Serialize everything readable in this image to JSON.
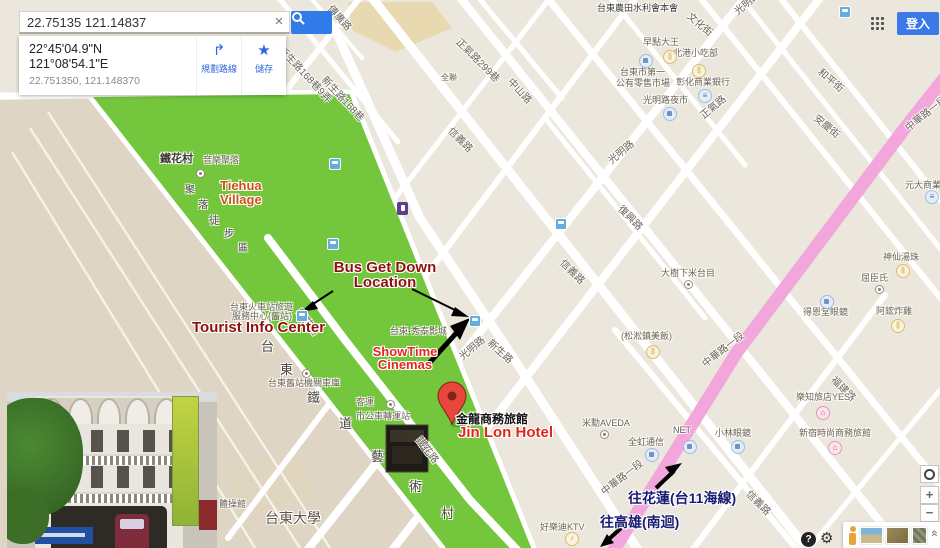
{
  "topbar": {
    "signin": "登入"
  },
  "search": {
    "query": "22.75135 121.14837",
    "clear": "×"
  },
  "place_card": {
    "lat_dms": "22°45'04.9\"N",
    "lng_dms": "121°08'54.1\"E",
    "decimal": "22.751350, 121.148370",
    "directions_label": "規劃路線",
    "directions_glyph": "↱",
    "save_label": "儲存",
    "save_glyph": "★"
  },
  "annotations": {
    "bus_line1": "Bus Get Down",
    "bus_line2": "Location",
    "tourist": "Tourist Info Center",
    "showtime_line1": "ShowTime",
    "showtime_line2": "Cinemas",
    "jinlon_cn": "金龍商務旅館",
    "jinlon_en": "Jin Lon Hotel",
    "tiehua_line1": "Tiehua",
    "tiehua_line2": "Village",
    "hualien": "往花蓮(台11海線)",
    "kaohsiung": "往高雄(南迴)"
  },
  "colors": {
    "park_green": "#74C63C",
    "major_road_pink": "#F2A6DC",
    "pin_red": "#E8453C",
    "annotation_dark_red": "#8D120D",
    "annotation_red": "#DE2A1C",
    "annotation_navy": "#181C72",
    "search_blue": "#2E7BE9",
    "signin_blue": "#3B78E8"
  },
  "controls": {
    "zoom_in": "+",
    "zoom_out": "−",
    "help": "?",
    "collapse": "«"
  },
  "map": {
    "street_labels": [
      {
        "t": "傳廣路",
        "x": 336,
        "y": 1,
        "r": 48
      },
      {
        "t": "新生路168巷9弄",
        "x": 287,
        "y": 42,
        "r": 47
      },
      {
        "t": "新生路168巷",
        "x": 330,
        "y": 72,
        "r": 47
      },
      {
        "t": "正氣路299巷",
        "x": 464,
        "y": 34,
        "r": 45
      },
      {
        "t": "中山路",
        "x": 516,
        "y": 74,
        "r": 47
      },
      {
        "t": "文化街",
        "x": 694,
        "y": 8,
        "r": 40
      },
      {
        "t": "和平街",
        "x": 825,
        "y": 64,
        "r": 40
      },
      {
        "t": "安慶街",
        "x": 821,
        "y": 110,
        "r": 40
      },
      {
        "t": "光明路",
        "x": 730,
        "y": 6,
        "r": -40
      },
      {
        "t": "光明路",
        "x": 604,
        "y": 155,
        "r": -40
      },
      {
        "t": "光明路",
        "x": 455,
        "y": 351,
        "r": -40
      },
      {
        "t": "正氣路",
        "x": 696,
        "y": 110,
        "r": -40
      },
      {
        "t": "信義路",
        "x": 456,
        "y": 123,
        "r": 45
      },
      {
        "t": "信義路",
        "x": 568,
        "y": 255,
        "r": 45
      },
      {
        "t": "信義路",
        "x": 754,
        "y": 486,
        "r": 45
      },
      {
        "t": "新生路",
        "x": 495,
        "y": 335,
        "r": 42
      },
      {
        "t": "鐵花路",
        "x": 305,
        "y": 305,
        "r": 52
      },
      {
        "t": "鐵花路",
        "x": 425,
        "y": 433,
        "r": 52
      },
      {
        "t": "復興路",
        "x": 626,
        "y": 201,
        "r": 45
      },
      {
        "t": "福建路",
        "x": 839,
        "y": 372,
        "r": 45
      },
      {
        "t": "中華路一段",
        "x": 901,
        "y": 122,
        "r": -38
      },
      {
        "t": "中華路一段",
        "x": 698,
        "y": 358,
        "r": -38
      },
      {
        "t": "中華路一段",
        "x": 597,
        "y": 486,
        "r": -38
      }
    ],
    "poi_labels": [
      {
        "t": "台東農田水利會本會",
        "x": 597,
        "y": 1,
        "s": 9,
        "c": "#3A3A3A"
      },
      {
        "t": "鐵花村",
        "x": 160,
        "y": 150,
        "s": 11,
        "c": "#3F3A31",
        "b": 1
      },
      {
        "t": "音樂聚落",
        "x": 203,
        "y": 153,
        "s": 9
      },
      {
        "t": "台東火車站旅遊",
        "x": 230,
        "y": 300,
        "s": 9
      },
      {
        "t": "服務中心(舊站)",
        "x": 232,
        "y": 309,
        "s": 9
      },
      {
        "t": "台東舊站機關車庫",
        "x": 268,
        "y": 376,
        "s": 9
      },
      {
        "t": "客運",
        "x": 356,
        "y": 395,
        "s": 9
      },
      {
        "t": "市公車轉運站",
        "x": 356,
        "y": 409,
        "s": 9
      },
      {
        "t": "台東·秀泰影城",
        "x": 390,
        "y": 324,
        "s": 9
      },
      {
        "t": "台東大學",
        "x": 265,
        "y": 508,
        "s": 14,
        "c": "#5F5648"
      },
      {
        "t": "體操館",
        "x": 219,
        "y": 497,
        "s": 9
      },
      {
        "t": "好樂迪KTV",
        "x": 540,
        "y": 520,
        "s": 9
      },
      {
        "t": "早點大王",
        "x": 643,
        "y": 35,
        "s": 9
      },
      {
        "t": "北港小吃部",
        "x": 673,
        "y": 46,
        "s": 9
      },
      {
        "t": "台東市第一",
        "x": 620,
        "y": 65,
        "s": 9
      },
      {
        "t": "公有零售市場",
        "x": 616,
        "y": 76,
        "s": 9
      },
      {
        "t": "彰化商業銀行",
        "x": 676,
        "y": 75,
        "s": 9
      },
      {
        "t": "光明路夜市",
        "x": 643,
        "y": 93,
        "s": 9
      },
      {
        "t": "大樹下米台目",
        "x": 661,
        "y": 266,
        "s": 9
      },
      {
        "t": "(松淞鎮美飯)",
        "x": 621,
        "y": 329,
        "s": 9
      },
      {
        "t": "得恩堂眼鏡",
        "x": 803,
        "y": 305,
        "s": 9
      },
      {
        "t": "神仙湯珠",
        "x": 883,
        "y": 250,
        "s": 9
      },
      {
        "t": "屈臣氏",
        "x": 861,
        "y": 271,
        "s": 9
      },
      {
        "t": "阿鋐炸雞",
        "x": 876,
        "y": 304,
        "s": 9
      },
      {
        "t": "元大商業銀行",
        "x": 905,
        "y": 178,
        "s": 9
      },
      {
        "t": "全聯",
        "x": 441,
        "y": 72,
        "s": 8
      },
      {
        "t": "米勳AVEDA",
        "x": 582,
        "y": 416,
        "s": 9
      },
      {
        "t": "全虹通信",
        "x": 628,
        "y": 435,
        "s": 9
      },
      {
        "t": "NET",
        "x": 673,
        "y": 425,
        "s": 9
      },
      {
        "t": "小林眼鏡",
        "x": 715,
        "y": 426,
        "s": 9
      },
      {
        "t": "樂知旅店YES",
        "x": 796,
        "y": 390,
        "s": 9
      },
      {
        "t": "新宿時尚商務旅館",
        "x": 799,
        "y": 426,
        "s": 9
      }
    ],
    "vertical_chars": [
      {
        "t": "台",
        "x": 261,
        "y": 336,
        "s": 13
      },
      {
        "t": "東",
        "x": 280,
        "y": 359,
        "s": 13
      },
      {
        "t": "鐵",
        "x": 307,
        "y": 387,
        "s": 13
      },
      {
        "t": "道",
        "x": 339,
        "y": 413,
        "s": 13
      },
      {
        "t": "藝",
        "x": 371,
        "y": 446,
        "s": 13
      },
      {
        "t": "術",
        "x": 409,
        "y": 476,
        "s": 13
      },
      {
        "t": "村",
        "x": 441,
        "y": 503,
        "s": 13
      },
      {
        "t": "聚",
        "x": 185,
        "y": 181,
        "s": 10
      },
      {
        "t": "落",
        "x": 198,
        "y": 196,
        "s": 10
      },
      {
        "t": "徒",
        "x": 209,
        "y": 212,
        "s": 10
      },
      {
        "t": "步",
        "x": 224,
        "y": 225,
        "s": 10
      },
      {
        "t": "區",
        "x": 238,
        "y": 239,
        "s": 10
      }
    ],
    "icons": [
      {
        "type": "bus",
        "x": 296,
        "y": 310
      },
      {
        "type": "bus",
        "x": 469,
        "y": 315
      },
      {
        "type": "bus",
        "x": 329,
        "y": 158
      },
      {
        "type": "bus",
        "x": 327,
        "y": 238
      },
      {
        "type": "bus",
        "x": 555,
        "y": 218
      },
      {
        "type": "bus",
        "x": 839,
        "y": 6
      },
      {
        "type": "rest",
        "x": 663,
        "y": 50
      },
      {
        "type": "rest",
        "x": 692,
        "y": 64
      },
      {
        "type": "rest",
        "x": 646,
        "y": 345
      },
      {
        "type": "rest",
        "x": 896,
        "y": 264
      },
      {
        "type": "rest",
        "x": 891,
        "y": 319
      },
      {
        "type": "ktv",
        "x": 565,
        "y": 532
      },
      {
        "type": "shop",
        "x": 639,
        "y": 54
      },
      {
        "type": "shop",
        "x": 663,
        "y": 107
      },
      {
        "type": "shop",
        "x": 820,
        "y": 295
      },
      {
        "type": "shop",
        "x": 645,
        "y": 448
      },
      {
        "type": "shop",
        "x": 683,
        "y": 440
      },
      {
        "type": "shop",
        "x": 731,
        "y": 440
      },
      {
        "type": "bank",
        "x": 698,
        "y": 89
      },
      {
        "type": "bank",
        "x": 925,
        "y": 190
      },
      {
        "type": "hotel",
        "x": 816,
        "y": 406
      },
      {
        "type": "hotel",
        "x": 828,
        "y": 441
      },
      {
        "type": "dot",
        "x": 684,
        "y": 280
      },
      {
        "type": "dot",
        "x": 875,
        "y": 285
      },
      {
        "type": "dot",
        "x": 302,
        "y": 369
      },
      {
        "type": "dot",
        "x": 386,
        "y": 400
      },
      {
        "type": "dot",
        "x": 600,
        "y": 430
      },
      {
        "type": "dot",
        "x": 196,
        "y": 169
      },
      {
        "type": "poi_purple",
        "x": 397,
        "y": 202
      }
    ]
  }
}
